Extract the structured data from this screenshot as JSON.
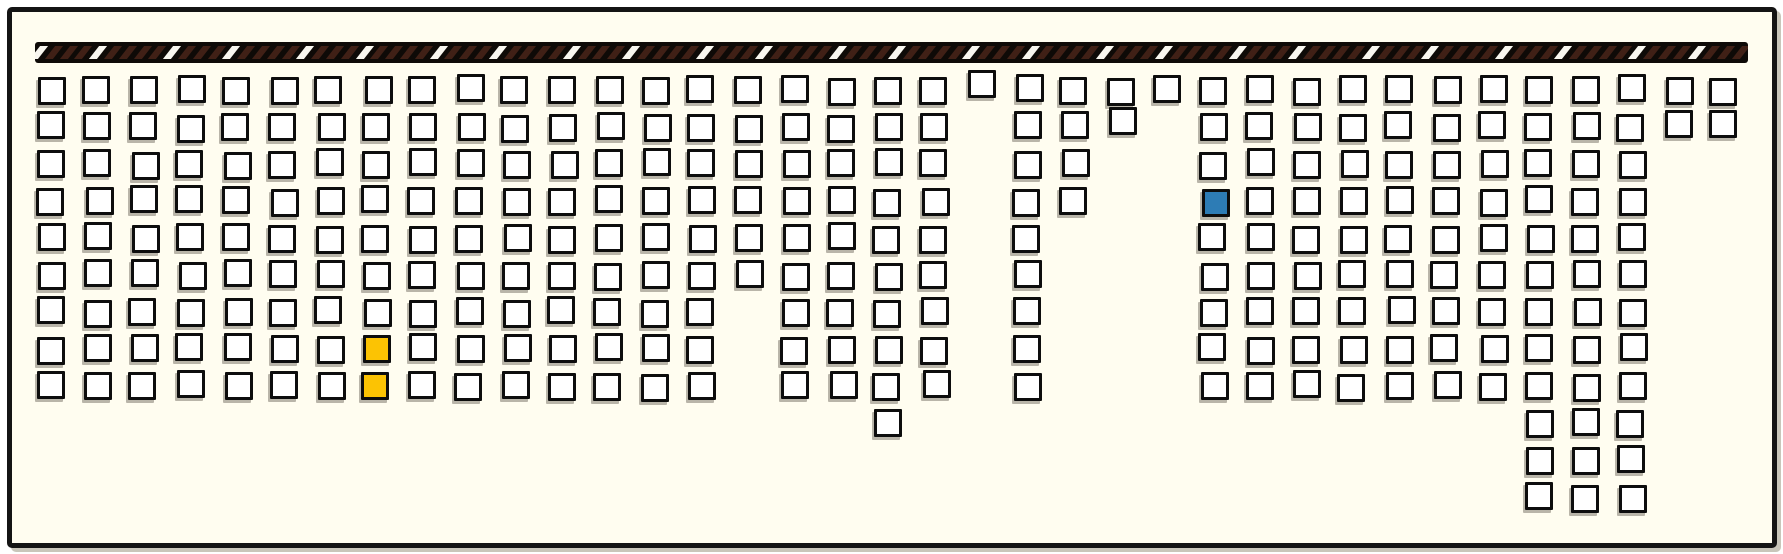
{
  "canvas": {
    "width": 1783,
    "height": 554,
    "outer_background": "#ffffff",
    "panel_background": "#fffdf0",
    "panel_border_color": "#141414",
    "panel_shadow_color": "#c9c6ba"
  },
  "hazard_bar": {
    "x": 35,
    "y": 42,
    "width": 1713,
    "height": 21,
    "background": "#0e0a07",
    "stripe_color": "#402016",
    "white_stripe_color": "#f8f6ef",
    "stripe_pitch": 14.8,
    "stripe_width": 7.6,
    "stripe_inset_top": 4,
    "stripe_height": 13,
    "skew_deg": -38,
    "white_mod": 9,
    "white_residues": [
      0,
      4
    ]
  },
  "grid": {
    "origin_x": 37,
    "origin_y": 76,
    "pitch_x": 46.5,
    "pitch_y": 37,
    "cell_size": 28,
    "cell_border_width": 3,
    "cell_fill": "#ffffff",
    "cell_border_color": "#0d0d0d",
    "cell_shadow_color": "#b9b5a9",
    "num_columns": 37,
    "num_rows": 12,
    "rows": [
      {
        "row": 1,
        "col_ranges": [
          [
            1,
            37
          ]
        ]
      },
      {
        "row": 2,
        "col_ranges": [
          [
            1,
            20
          ],
          [
            22,
            24
          ],
          [
            26,
            37
          ]
        ]
      },
      {
        "row": 3,
        "col_ranges": [
          [
            1,
            20
          ],
          [
            22,
            23
          ],
          [
            26,
            35
          ]
        ]
      },
      {
        "row": 4,
        "col_ranges": [
          [
            1,
            20
          ],
          [
            22,
            23
          ],
          [
            26,
            35
          ]
        ]
      },
      {
        "row": 5,
        "col_ranges": [
          [
            1,
            20
          ],
          [
            22,
            22
          ],
          [
            26,
            35
          ]
        ]
      },
      {
        "row": 6,
        "col_ranges": [
          [
            1,
            20
          ],
          [
            22,
            22
          ],
          [
            26,
            35
          ]
        ]
      },
      {
        "row": 7,
        "col_ranges": [
          [
            1,
            15
          ],
          [
            17,
            20
          ],
          [
            22,
            22
          ],
          [
            26,
            35
          ]
        ]
      },
      {
        "row": 8,
        "col_ranges": [
          [
            1,
            15
          ],
          [
            17,
            20
          ],
          [
            22,
            22
          ],
          [
            26,
            35
          ]
        ]
      },
      {
        "row": 9,
        "col_ranges": [
          [
            1,
            15
          ],
          [
            17,
            20
          ],
          [
            22,
            22
          ],
          [
            26,
            35
          ]
        ]
      },
      {
        "row": 10,
        "col_ranges": [
          [
            19,
            19
          ],
          [
            33,
            35
          ]
        ]
      },
      {
        "row": 11,
        "col_ranges": [
          [
            33,
            35
          ]
        ]
      },
      {
        "row": 12,
        "col_ranges": [
          [
            33,
            35
          ]
        ]
      }
    ],
    "highlight_cells": [
      {
        "row": 4,
        "col": 26,
        "color": "#2d7cb5",
        "name": "selected-cell-blue"
      },
      {
        "row": 8,
        "col": 8,
        "color": "#fcc303",
        "name": "selected-cell-yellow-1"
      },
      {
        "row": 9,
        "col": 8,
        "color": "#fcc303",
        "name": "selected-cell-yellow-2"
      }
    ],
    "offset_overrides": {
      "1-21": [
        0,
        -7
      ],
      "2-24": [
        0,
        -6
      ],
      "2-36": [
        0,
        -4
      ],
      "2-37": [
        0,
        -4
      ]
    }
  }
}
